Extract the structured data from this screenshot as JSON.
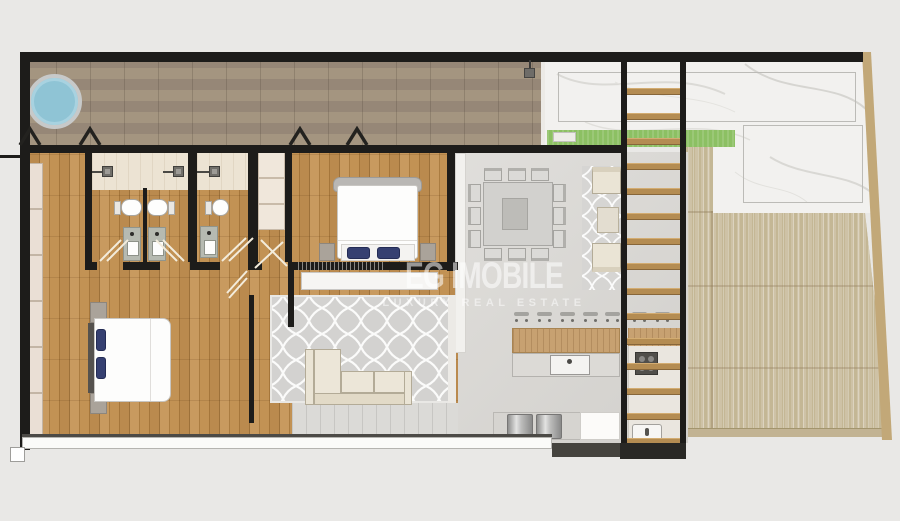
{
  "watermark": {
    "title": "EG IMOBILE",
    "subtitle": "LUXURY REAL ESTATE"
  },
  "palette": {
    "background": "#e9e8e6",
    "walls": "#1d1c1a",
    "hot_tub_blue": "#8fc4d5",
    "lawn_green": "#8cc063",
    "interior_oak_floor": "#b08045",
    "pool_deck_wood": "#9c8d7c",
    "terrace_deck_wood": "#ccc0a3",
    "marble_terrace": "#f2f1ef",
    "concrete_floor": "#d9d7d3",
    "bathroom_tile": "#ece3d3",
    "rug_gray": "#d3d2d0",
    "sofa_cream": "#eae4d5",
    "pillow_navy": "#364071",
    "stair_tread_wood": "#b48c52"
  },
  "icons": {
    "door_marker": "chevron",
    "shower_head": "square-with-arm",
    "bar_stool": "bar-with-dots",
    "faucet": "dot"
  }
}
